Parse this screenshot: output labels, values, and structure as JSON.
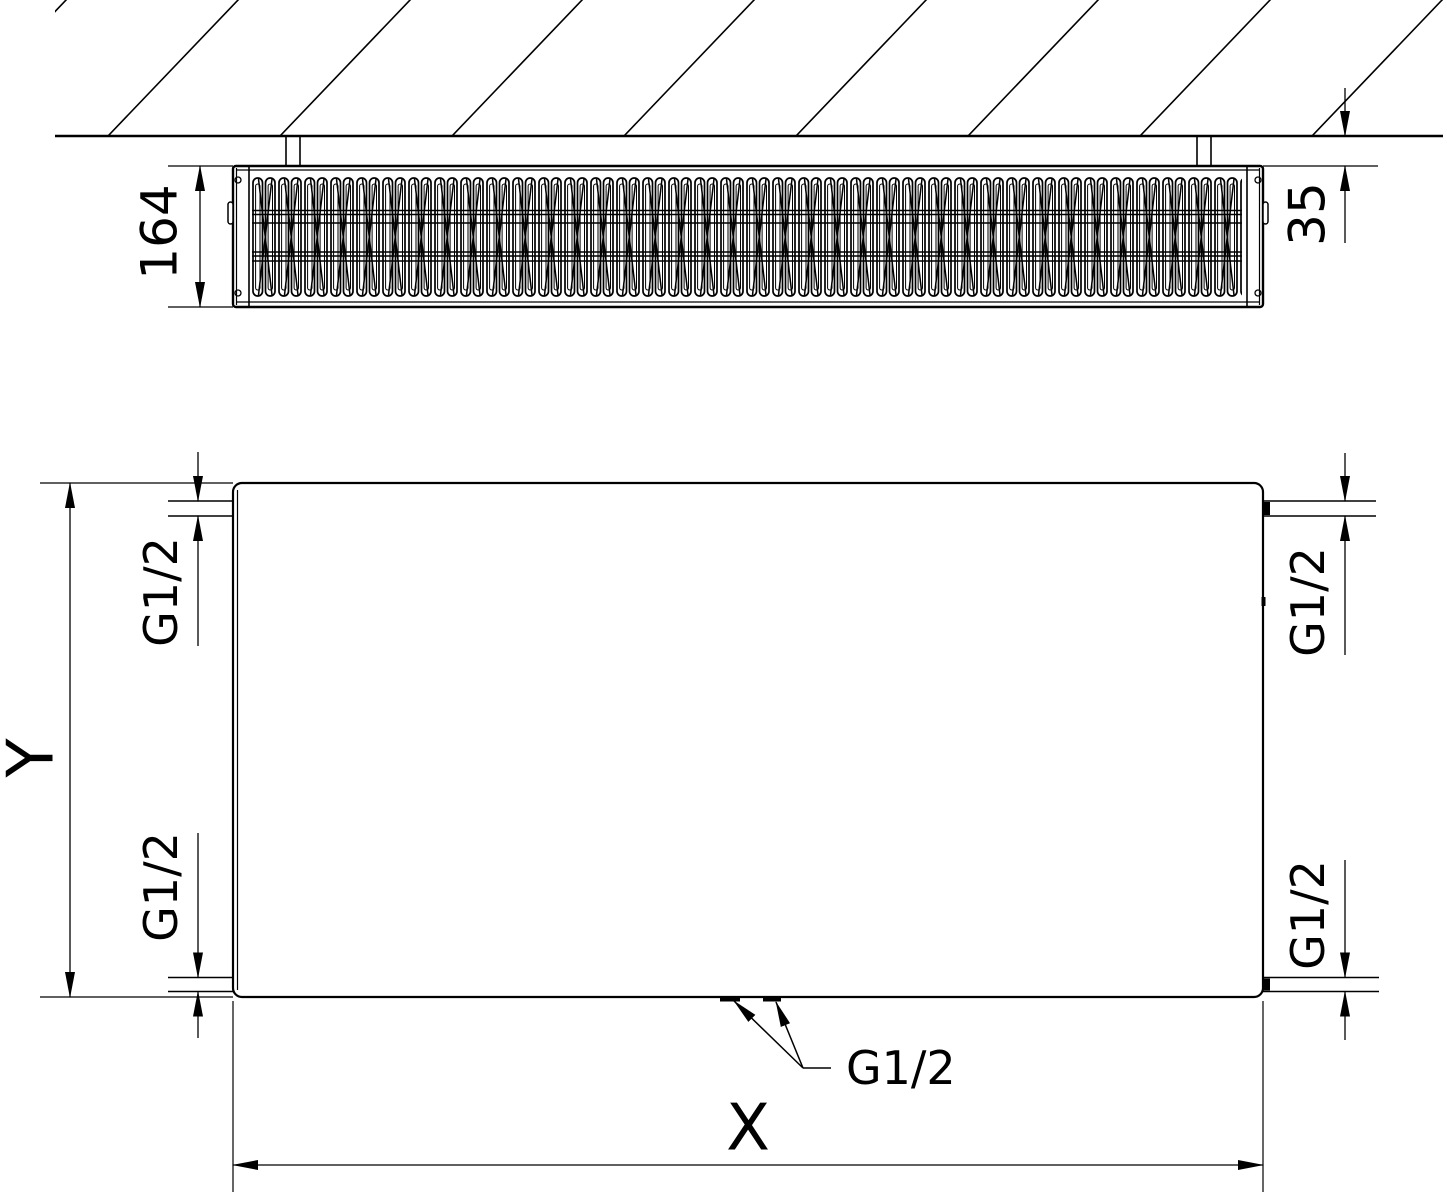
{
  "drawing": {
    "title": "radiator-technical-drawing",
    "colors": {
      "line": "#000000",
      "background": "#ffffff"
    },
    "top_view": {
      "depth_label": "164",
      "wall_clearance_label": "35"
    },
    "front_view": {
      "height_label": "Y",
      "width_label": "X",
      "conn_top_left": "G1/2",
      "conn_bottom_left": "G1/2",
      "conn_top_right": "G1/2",
      "conn_bottom_right": "G1/2",
      "conn_bottom_center": "G1/2"
    }
  }
}
